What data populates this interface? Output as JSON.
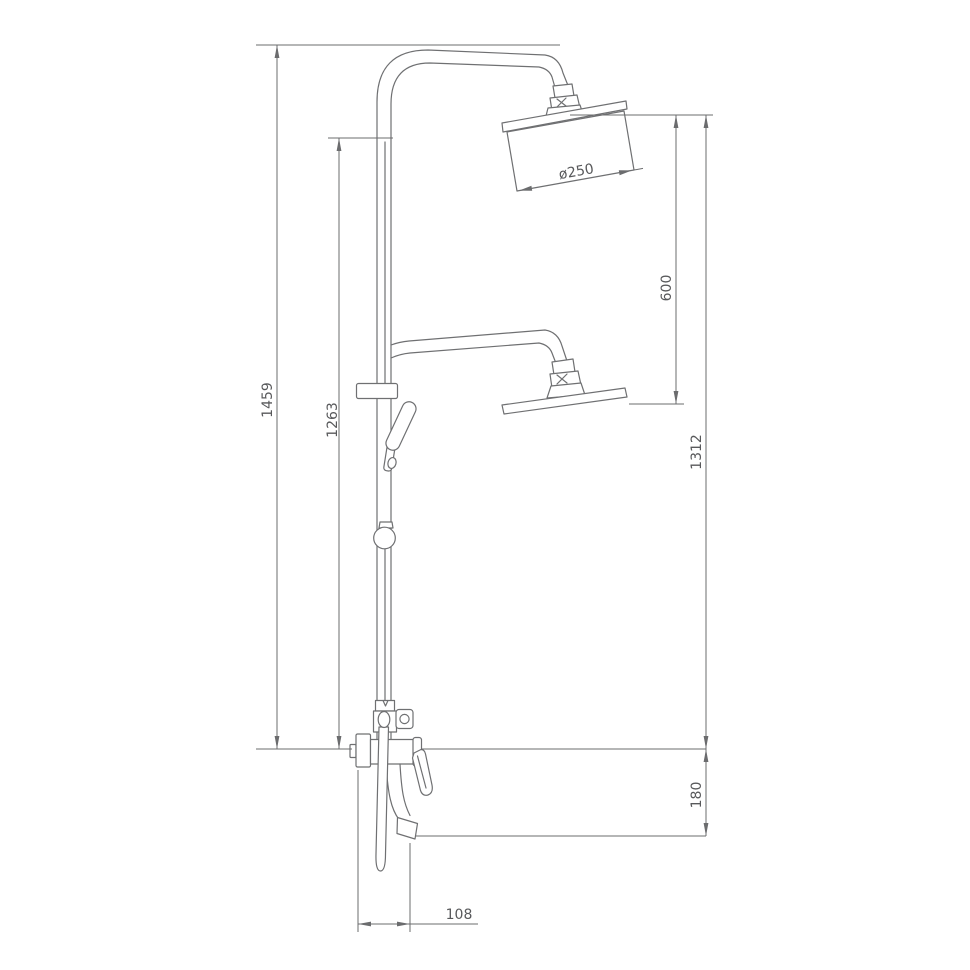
{
  "drawing": {
    "subject": "shower-column-technical-drawing",
    "background": "#ffffff",
    "line_color": "#6f7072",
    "dimension_line_color": "#6b6c6e",
    "dimension_text_color": "#58595b",
    "dimensions": [
      {
        "id": "overall-height",
        "value": "1459",
        "orientation": "vertical"
      },
      {
        "id": "rail-height",
        "value": "1263",
        "orientation": "vertical"
      },
      {
        "id": "head-diameter",
        "value": "ø250",
        "orientation": "diagonal"
      },
      {
        "id": "head-spacing",
        "value": "600",
        "orientation": "vertical"
      },
      {
        "id": "riser-top-height",
        "value": "1312",
        "orientation": "vertical"
      },
      {
        "id": "spout-drop",
        "value": "180",
        "orientation": "vertical"
      },
      {
        "id": "spout-reach",
        "value": "108",
        "orientation": "horizontal"
      }
    ]
  }
}
